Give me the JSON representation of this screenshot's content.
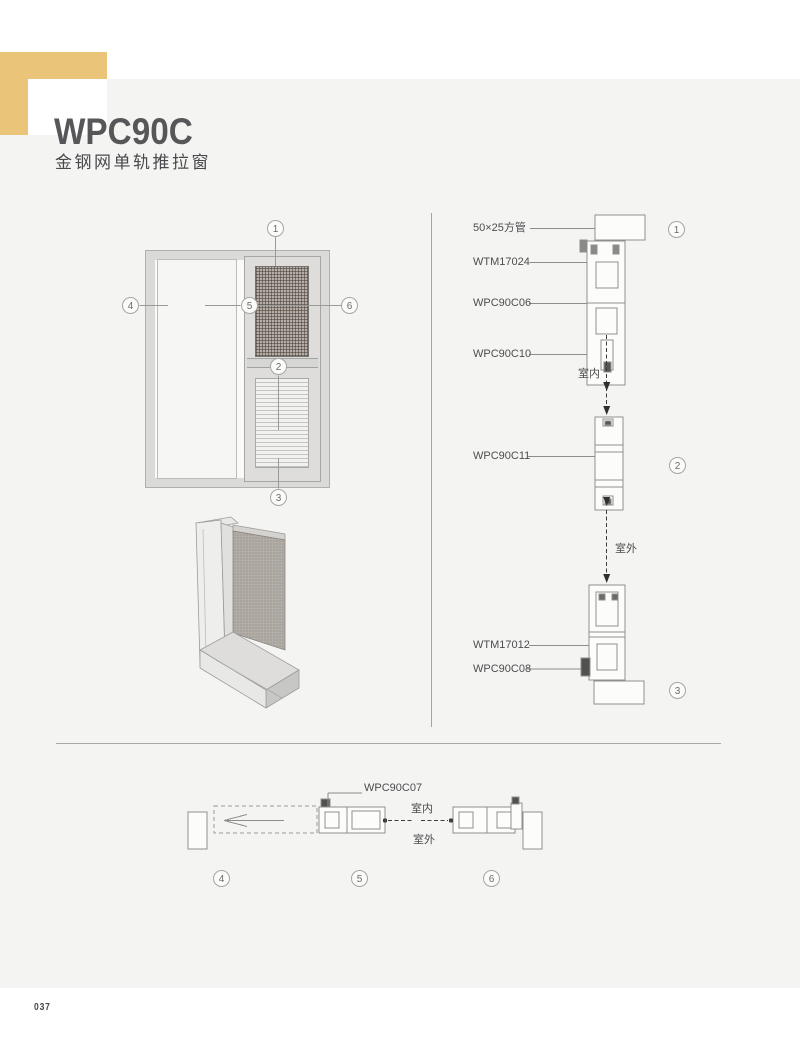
{
  "header": {
    "title": "WPC90C",
    "subtitle": "金钢网单轨推拉窗"
  },
  "page": {
    "number": "037"
  },
  "elevation": {
    "callouts": {
      "c1": "1",
      "c2": "2",
      "c3": "3",
      "c4": "4",
      "c5": "5",
      "c6": "6"
    }
  },
  "vertical_section": {
    "callouts": {
      "c1": "1",
      "c2": "2",
      "c3": "3"
    },
    "labels": {
      "square_tube": "50×25方管",
      "wtm17024": "WTM17024",
      "wpc90c06": "WPC90C06",
      "wpc90c10": "WPC90C10",
      "indoor": "室内",
      "wpc90c11": "WPC90C11",
      "outdoor": "室外",
      "wtm17012": "WTM17012",
      "wpc90c08": "WPC90C08"
    }
  },
  "horizontal_section": {
    "callouts": {
      "c4": "4",
      "c5": "5",
      "c6": "6"
    },
    "labels": {
      "wpc90c07": "WPC90C07",
      "indoor": "室内",
      "outdoor": "室外"
    }
  },
  "colors": {
    "accent": "#EAC478",
    "panel": "#F4F4F2",
    "line": "#9A9A98",
    "mesh": "#B4AEA7"
  }
}
